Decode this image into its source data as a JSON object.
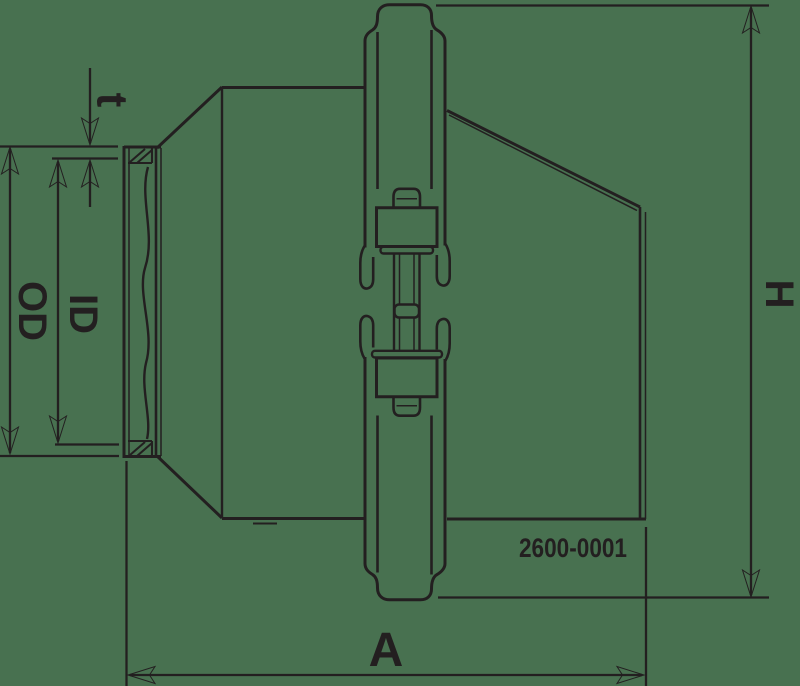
{
  "drawing": {
    "type": "technical-drawing",
    "part_number": "2600-0001",
    "dimension_labels": {
      "wall_thickness": "t",
      "inner_diameter": "ID",
      "outer_diameter": "OD",
      "height": "H",
      "length": "A"
    },
    "colors": {
      "line": "#231f20",
      "background": "#487150"
    }
  }
}
